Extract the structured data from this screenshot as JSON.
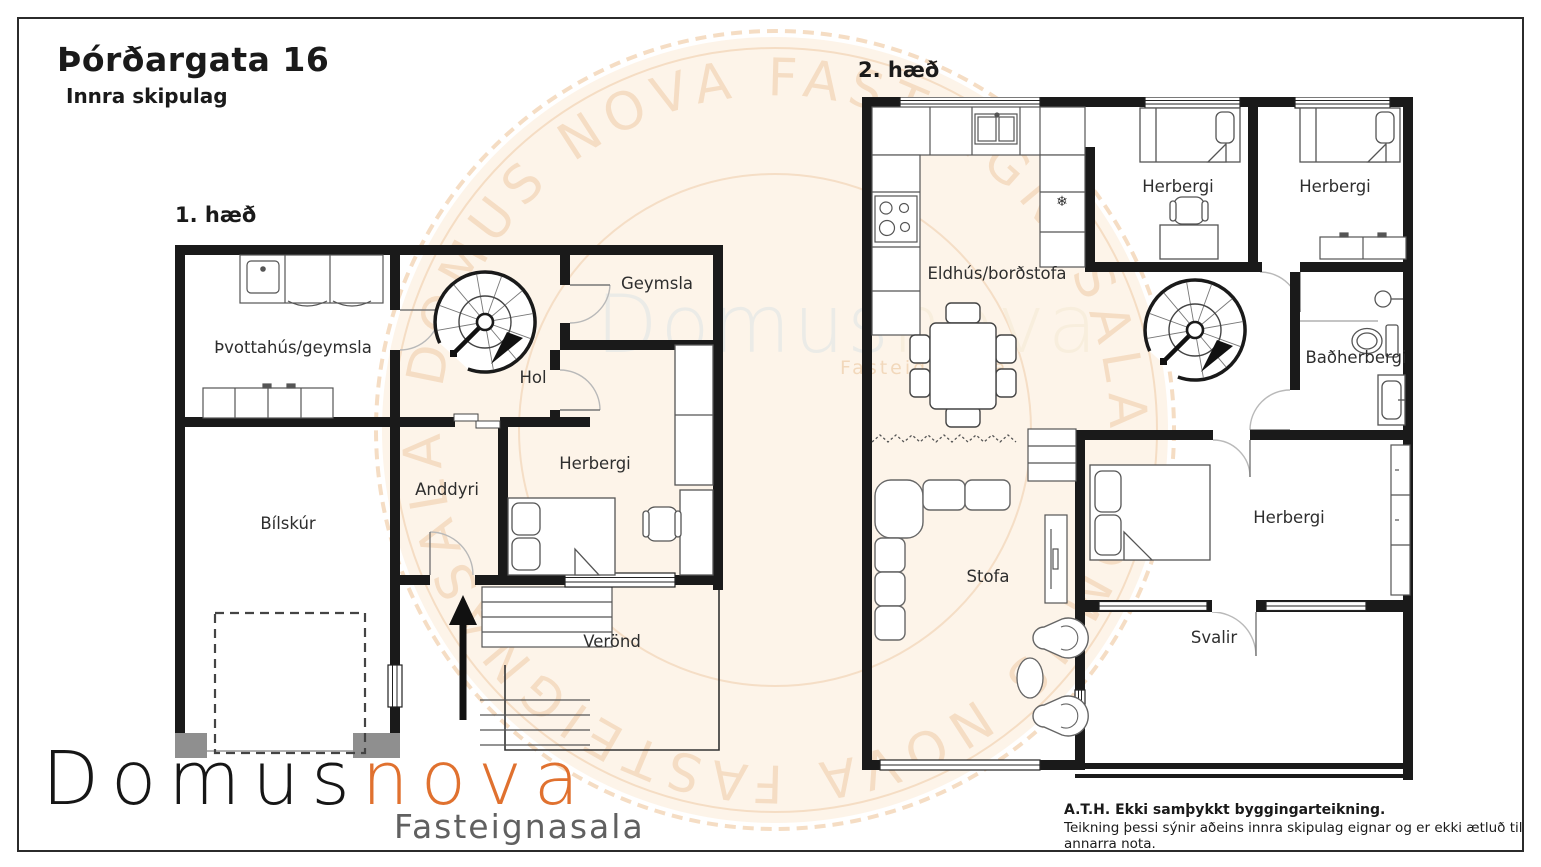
{
  "page": {
    "title": "Þórðargata 16",
    "subtitle": "Innra skipulag"
  },
  "floor1": {
    "label": "1. hæð",
    "rooms": {
      "laundry": "Þvottahús/geymsla",
      "storage": "Geymsla",
      "hall": "Hol",
      "bedroom": "Herbergi",
      "entry": "Anddyri",
      "garage": "Bílskúr",
      "porch": "Verönd"
    }
  },
  "floor2": {
    "label": "2. hæð",
    "rooms": {
      "kitchen": "Eldhús/borðstofa",
      "bedroom_a": "Herbergi",
      "bedroom_b": "Herbergi",
      "bathroom": "Baðherbergi",
      "living": "Stofa",
      "bedroom_c": "Herbergi",
      "balcony": "Svalir"
    },
    "fridge_symbol": "❄"
  },
  "watermark": {
    "arc_text": "DOMUS NOVA FASTEIGNASALA",
    "center_primary": "Domus",
    "center_secondary": "nova",
    "center_tagline": "Fasteignasala"
  },
  "logo": {
    "primary": "Domus",
    "secondary": "nova",
    "tagline": "Fasteignasala"
  },
  "disclaimer": {
    "line1": "A.T.H. Ekki samþykkt byggingarteikning.",
    "line2": "Teikning þessi sýnir aðeins innra skipulag eignar og er ekki ætluð til annarra nota."
  },
  "colors": {
    "wall": "#1a1a1a",
    "accent_orange": "#e0712f",
    "stamp": "#f0cfad",
    "logo_gray": "#606060",
    "jamb_gray": "#8f8f8f"
  }
}
